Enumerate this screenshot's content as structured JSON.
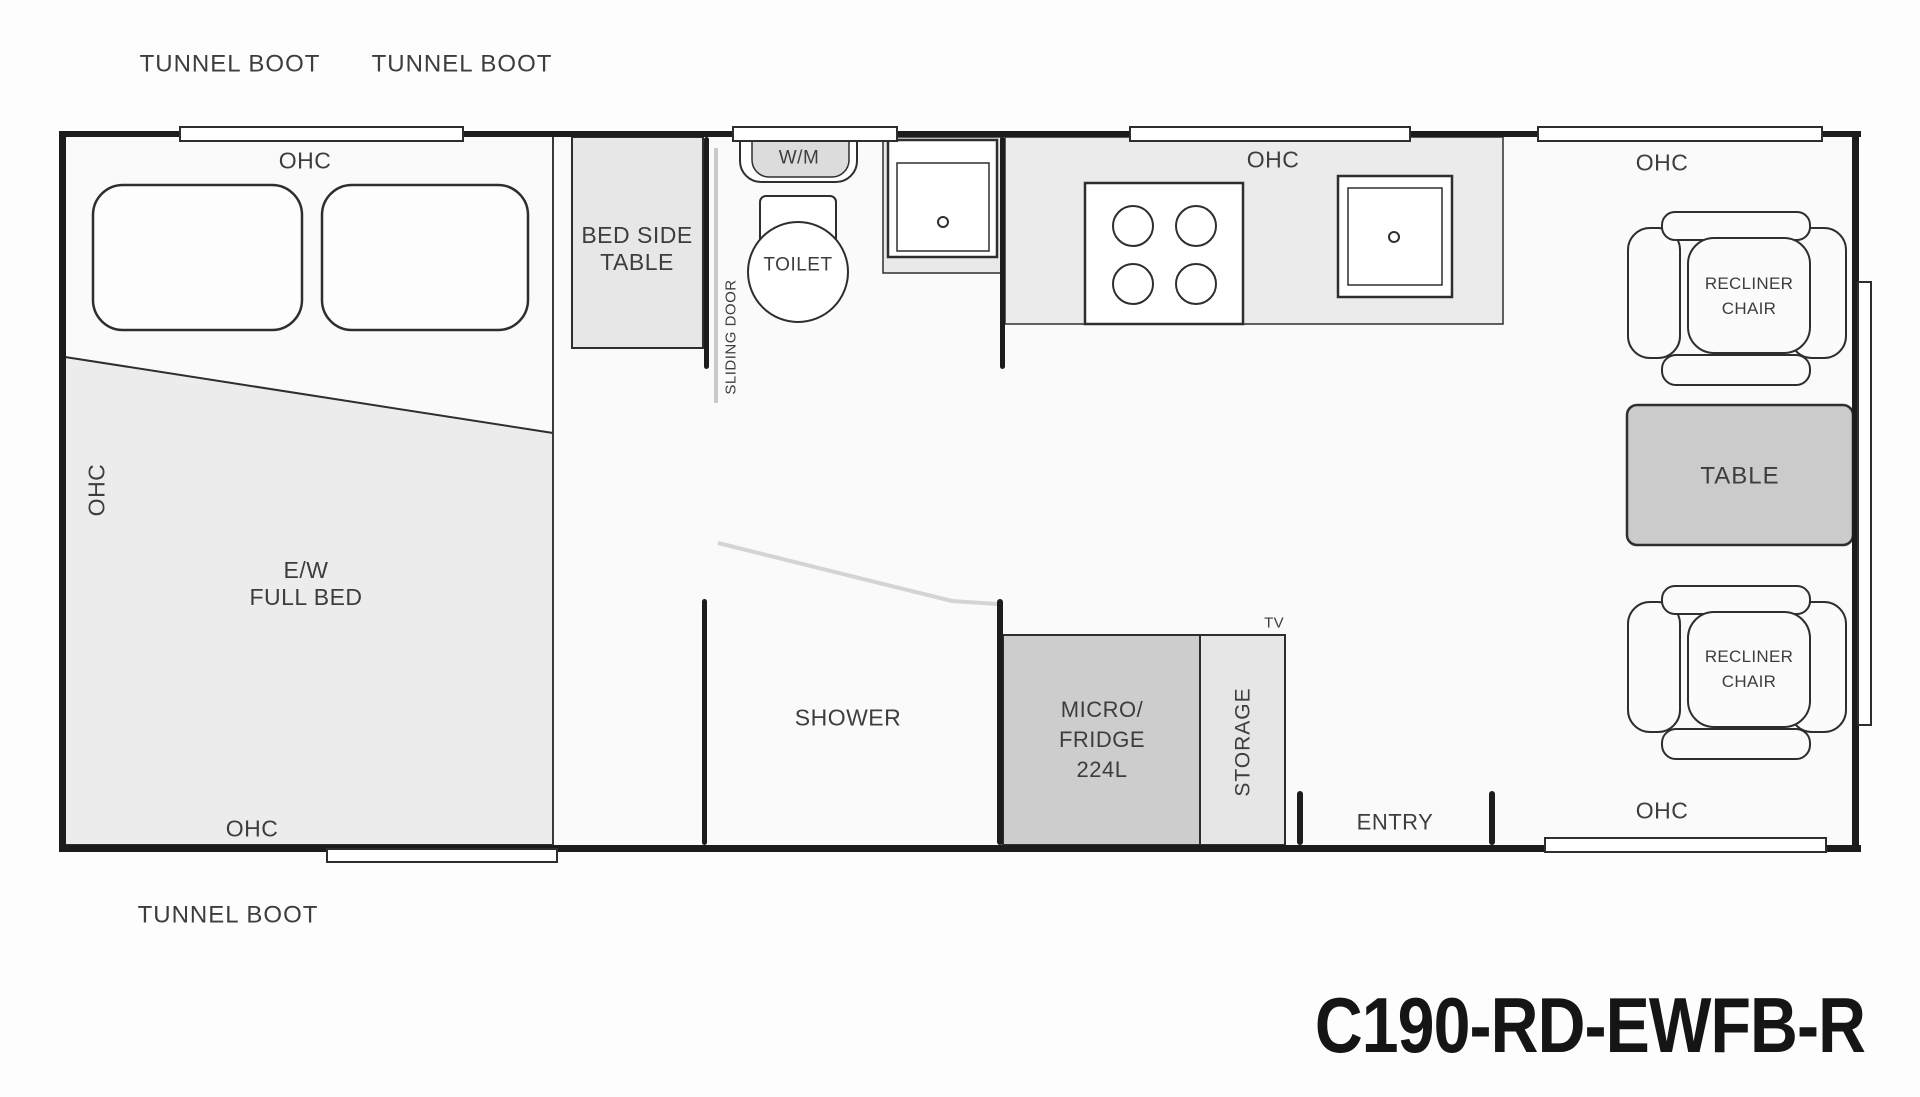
{
  "title": "Caravan floor plan",
  "model_code": "C190-RD-EWFB-R",
  "exterior": {
    "tunnel_boot_front_1": "TUNNEL BOOT",
    "tunnel_boot_front_2": "TUNNEL BOOT",
    "tunnel_boot_rear": "TUNNEL BOOT"
  },
  "bedroom": {
    "ohc_top": "OHC",
    "ohc_side": "OHC",
    "ohc_bottom": "OHC",
    "bed_line1": "E/W",
    "bed_line2": "FULL BED",
    "bed_side_table_line1": "BED SIDE",
    "bed_side_table_line2": "TABLE",
    "sliding_door": "SLIDING DOOR"
  },
  "bathroom": {
    "washing_machine": "W/M",
    "toilet": "TOILET",
    "shower": "SHOWER"
  },
  "kitchen": {
    "ohc": "OHC",
    "micro_fridge_line1": "MICRO/",
    "micro_fridge_line2": "FRIDGE",
    "micro_fridge_line3": "224L",
    "storage": "STORAGE",
    "tv": "TV"
  },
  "lounge": {
    "ohc_top": "OHC",
    "ohc_bottom": "OHC",
    "recliner_line1": "RECLINER",
    "recliner_line2": "CHAIR",
    "table": "TABLE",
    "entry": "ENTRY"
  },
  "colors": {
    "wall": "#1c1c1c",
    "outline": "#2e2e2e",
    "fill_light": "#ebebeb",
    "fill_mid": "#e0e0e0",
    "fill_dark": "#cbcbcb",
    "line_light": "#cfcfcf",
    "text": "#3d3d3d",
    "floor": "#fafafa",
    "background": "#fdfdfd"
  }
}
